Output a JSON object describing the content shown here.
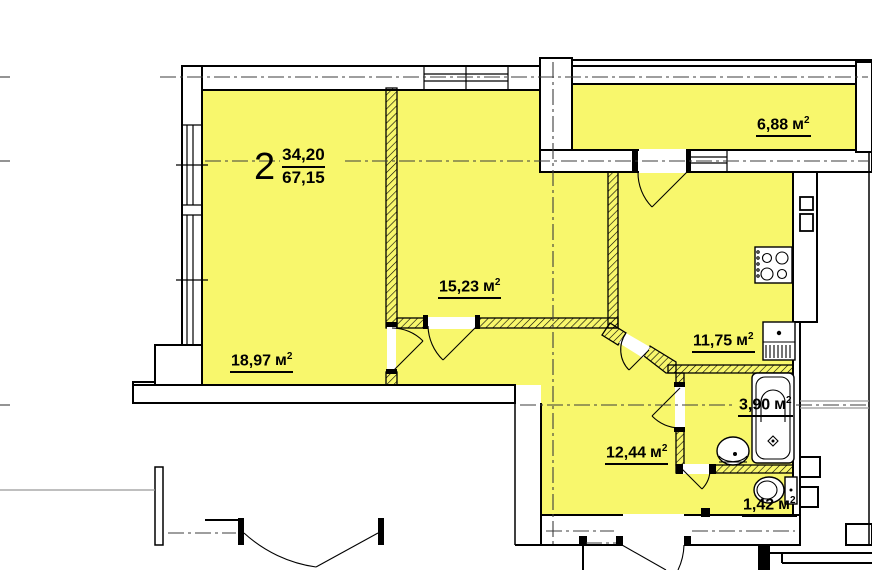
{
  "apartment": {
    "number": "2",
    "living_area": "34,20",
    "total_area": "67,15"
  },
  "rooms": {
    "living": {
      "area": "18,97",
      "unit": "м",
      "sup": "2"
    },
    "bedroom": {
      "area": "15,23",
      "unit": "м",
      "sup": "2"
    },
    "kitchen": {
      "area": "11,75",
      "unit": "м",
      "sup": "2"
    },
    "hall": {
      "area": "12,44",
      "unit": "м",
      "sup": "2"
    },
    "bathroom": {
      "area": "3,90",
      "unit": "м",
      "sup": "2"
    },
    "wc": {
      "area": "1,42",
      "unit": "м",
      "sup": "2"
    },
    "balcony": {
      "area": "6,88",
      "unit": "м",
      "sup": "2"
    }
  },
  "colors": {
    "room_fill": "#F8F76C",
    "wall": "#000000",
    "axis": "#3C3C3C"
  },
  "icons": {
    "stove": "stove-icon",
    "kitchen_sink": "kitchen-sink-icon",
    "bathtub": "bathtub-icon",
    "washbasin": "washbasin-icon",
    "toilet": "toilet-icon"
  }
}
